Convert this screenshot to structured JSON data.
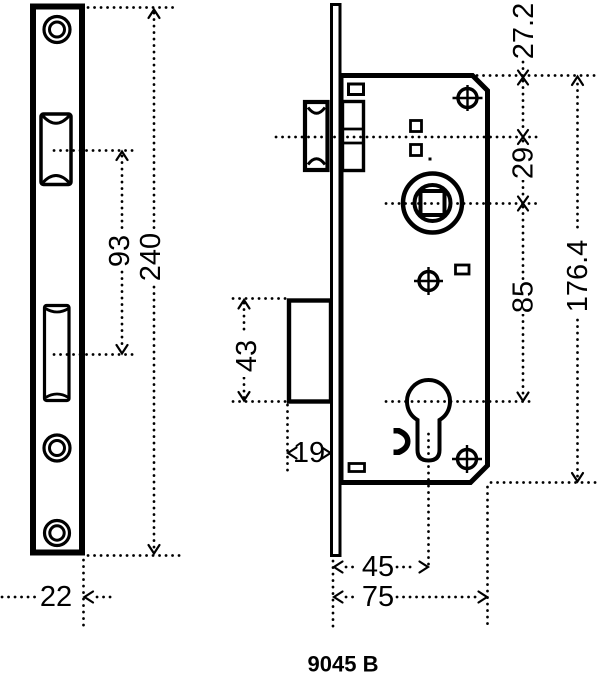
{
  "title": "9045 B",
  "colors": {
    "ink": "#000000",
    "paper": "#ffffff"
  },
  "dims": {
    "front": {
      "length": "240",
      "center_spacing": "93",
      "plate_width": "22"
    },
    "side": {
      "edge_to_latch": "27.2",
      "latch_to_spindle": "29",
      "spindle_to_cylinder": "85",
      "case_length": "176.4",
      "bolt_pocket": "43",
      "bolt_throw": "19",
      "backset": "45",
      "case_depth": "75"
    }
  }
}
